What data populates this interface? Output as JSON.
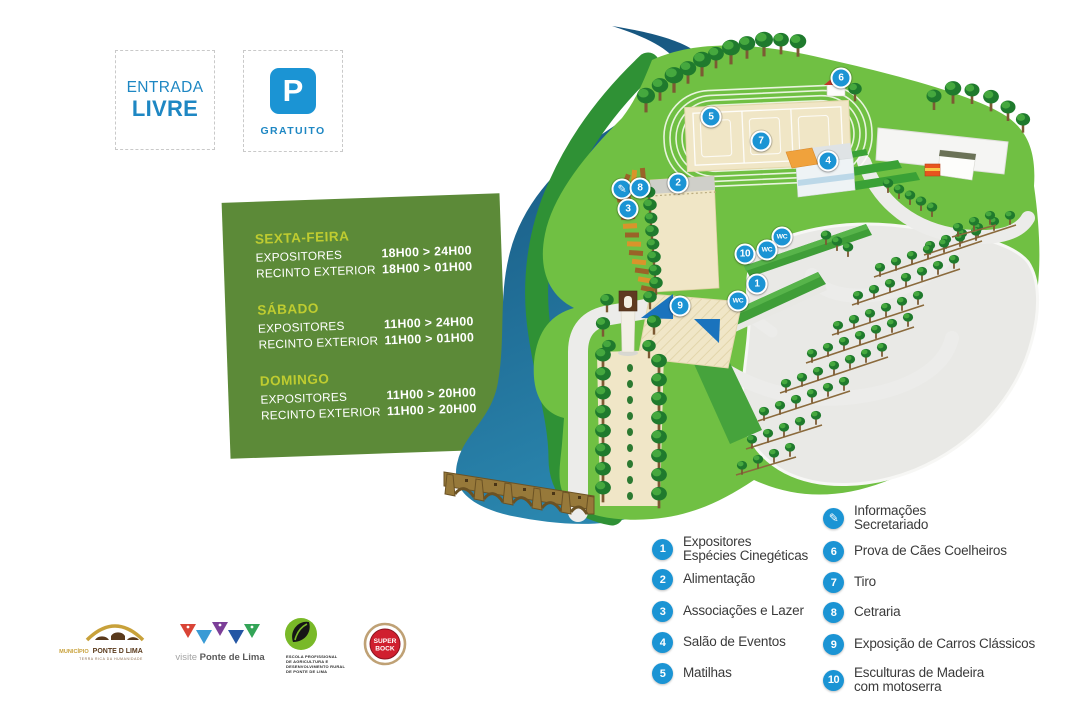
{
  "colors": {
    "accent_blue": "#1b94d4",
    "entry_blue": "#1e87c3",
    "text_dark": "#3a3a3a",
    "card_green": "#5c8a38",
    "card_highlight": "#bfcc30"
  },
  "entry_box": {
    "line1": "ENTRADA",
    "line2": "LIVRE"
  },
  "parking_box": {
    "symbol": "P",
    "label": "GRATUITO"
  },
  "schedule": {
    "days": [
      {
        "name": "SEXTA-FEIRA",
        "rows": [
          {
            "label": "EXPOSITORES",
            "time": "18H00 > 24H00"
          },
          {
            "label": "RECINTO EXTERIOR",
            "time": "18H00 > 01H00"
          }
        ]
      },
      {
        "name": "SÁBADO",
        "rows": [
          {
            "label": "EXPOSITORES",
            "time": "11H00 > 24H00"
          },
          {
            "label": "RECINTO EXTERIOR",
            "time": "11H00 > 01H00"
          }
        ]
      },
      {
        "name": "DOMINGO",
        "rows": [
          {
            "label": "EXPOSITORES",
            "time": "11H00 > 20H00"
          },
          {
            "label": "RECINTO EXTERIOR",
            "time": "11H00 > 20H00"
          }
        ]
      }
    ]
  },
  "map": {
    "markers": [
      {
        "id": "5",
        "x": 711,
        "y": 117
      },
      {
        "id": "7",
        "x": 761,
        "y": 141
      },
      {
        "id": "6",
        "x": 841,
        "y": 78
      },
      {
        "id": "4",
        "x": 828,
        "y": 161
      },
      {
        "id": "2",
        "x": 678,
        "y": 183
      },
      {
        "id": "info",
        "glyph": "✎",
        "x": 622,
        "y": 189
      },
      {
        "id": "8",
        "x": 640,
        "y": 188
      },
      {
        "id": "3",
        "x": 628,
        "y": 209
      },
      {
        "id": "10",
        "x": 745,
        "y": 254
      },
      {
        "id": "WC",
        "x": 782,
        "y": 237
      },
      {
        "id": "WC",
        "x": 767,
        "y": 250
      },
      {
        "id": "1",
        "x": 757,
        "y": 284
      },
      {
        "id": "WC",
        "x": 738,
        "y": 301
      },
      {
        "id": "9",
        "x": 680,
        "y": 306
      }
    ]
  },
  "legend": {
    "left": [
      {
        "badge": "1",
        "label": "Expositores\nEspécies Cinegéticas"
      },
      {
        "badge": "2",
        "label": "Alimentação"
      },
      {
        "badge": "3",
        "label": "Associações e Lazer"
      },
      {
        "badge": "4",
        "label": "Salão de Eventos"
      },
      {
        "badge": "5",
        "label": "Matilhas"
      }
    ],
    "right": [
      {
        "badge": "✎",
        "icon": "pencil-icon",
        "label": "Informações\nSecretariado"
      },
      {
        "badge": "6",
        "label": "Prova de Cães Coelheiros"
      },
      {
        "badge": "7",
        "label": "Tiro"
      },
      {
        "badge": "8",
        "label": "Cetraria"
      },
      {
        "badge": "9",
        "label": "Exposição de Carros Clássicos"
      },
      {
        "badge": "10",
        "label": "Esculturas de Madeira\ncom motoserra"
      }
    ]
  },
  "logos": {
    "municipio": {
      "word1": "MUNICÍPIO",
      "word2": "PONTE D LIMA",
      "tagline": "TERRA RICA DA HUMANIDADE"
    },
    "visite": {
      "prefix": "visite",
      "name": "Ponte de Lima"
    },
    "school": {
      "lines": [
        "ESCOLA PROFISSIONAL",
        "DE AGRICULTURA E",
        "DESENVOLVIMENTO RURAL",
        "DE PONTE DE LIMA"
      ]
    },
    "superbock": {
      "line1": "SUPER",
      "line2": "BOCK"
    }
  }
}
